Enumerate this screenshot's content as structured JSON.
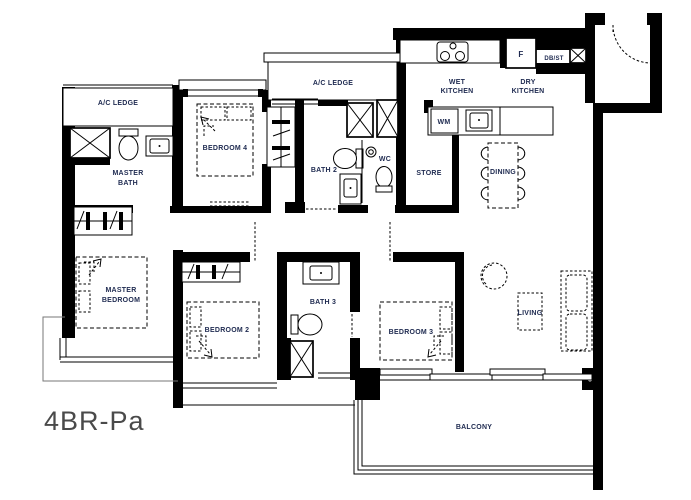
{
  "floorplan": {
    "unit_type": "4BR-Pa",
    "rooms": {
      "ac_ledge_left": "A/C LEDGE",
      "ac_ledge_mid": "A/C LEDGE",
      "master_bath_line1": "MASTER",
      "master_bath_line2": "BATH",
      "bedroom4": "BEDROOM 4",
      "bath2": "BATH 2",
      "wc": "WC",
      "store": "STORE",
      "wet_kitchen_line1": "WET",
      "wet_kitchen_line2": "KITCHEN",
      "dry_kitchen_line1": "DRY",
      "dry_kitchen_line2": "KITCHEN",
      "dining": "DINING",
      "master_bedroom_line1": "MASTER",
      "master_bedroom_line2": "BEDROOM",
      "bedroom2": "BEDROOM 2",
      "bath3": "BATH 3",
      "bedroom3": "BEDROOM 3",
      "living": "LIVING",
      "balcony": "BALCONY"
    },
    "appliances": {
      "fridge": "F",
      "washing_machine": "WM",
      "db_st": "DB/ST"
    },
    "colors": {
      "walls": "#000000",
      "room_label": "#1e2a50",
      "title": "#4a4a4a"
    }
  }
}
